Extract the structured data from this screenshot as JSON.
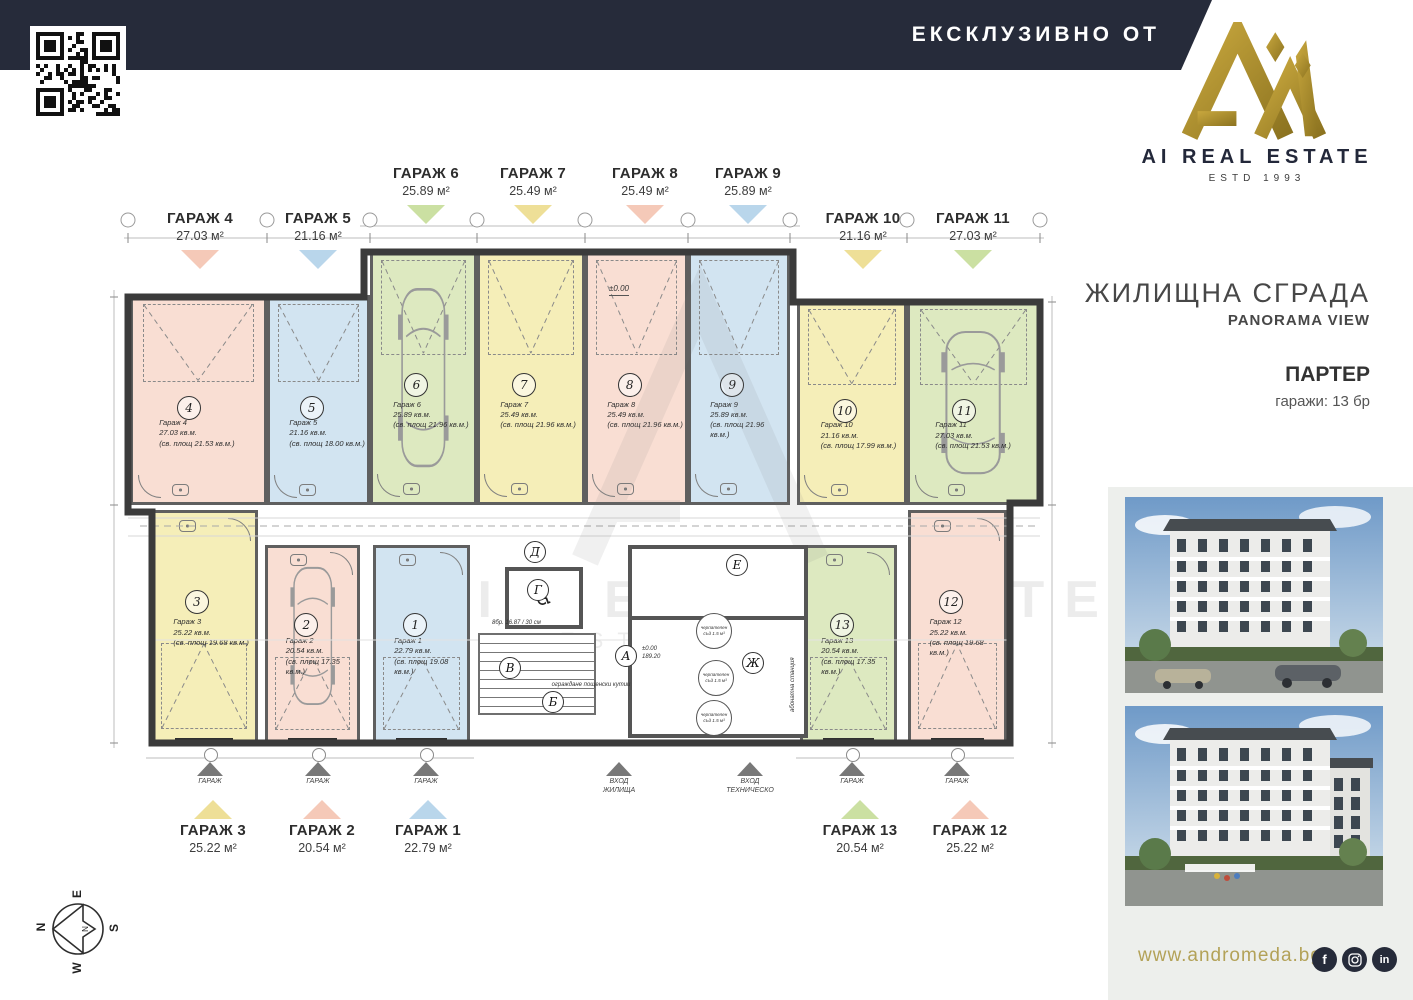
{
  "header": {
    "exclusive": "ЕКСКЛУЗИВНО ОТ"
  },
  "brand": {
    "name": "AI REAL ESTATE",
    "estd": "ESTD 1993"
  },
  "project": {
    "building": "ЖИЛИЩНА СГРАДА",
    "subtitle": "PANORAMA VIEW",
    "floor": "ПАРТЕР",
    "garages_count": "гаражи: 13 бр"
  },
  "footer": {
    "website": "www.andromeda.bg",
    "social": [
      {
        "name": "facebook",
        "glyph": "f"
      },
      {
        "name": "instagram",
        "glyph": ""
      },
      {
        "name": "linkedin",
        "glyph": "in"
      }
    ]
  },
  "compass": {
    "north": "N",
    "east": "E",
    "south": "S",
    "west": "W"
  },
  "colors": {
    "pink": "#f9ded3",
    "blue": "#d2e4f1",
    "green": "#dde9c0",
    "yellow": "#f5eeb8",
    "pink_arrow": "#f5c9b8",
    "blue_arrow": "#b9d6eb",
    "green_arrow": "#cbe0a2",
    "yellow_arrow": "#eedf97",
    "navy": "#262b3a",
    "gold": "#9b8028",
    "gold_text": "#b3a258",
    "panel": "#edefec"
  },
  "plan": {
    "level_mark": "±0.00",
    "area_mark": "189.20",
    "stairs_note": "8бр. 16.87 / 30 см",
    "mailboxes_label": "ограждане пощенски кутии",
    "substation_label": "абонатна станция",
    "tank_label": "черпателен съд 1.5 м³",
    "door_label": "ГАРАЖ",
    "entrances": [
      {
        "line1": "ВХОД",
        "line2": "ЖИЛИЩА"
      },
      {
        "line1": "ВХОД",
        "line2": "ТЕХНИЧЕСКО"
      }
    ],
    "core_rooms": [
      {
        "letter": "А"
      },
      {
        "letter": "Б"
      },
      {
        "letter": "В"
      },
      {
        "letter": "Г"
      },
      {
        "letter": "Д"
      },
      {
        "letter": "Е"
      },
      {
        "letter": "Ж"
      }
    ],
    "garages": [
      {
        "id": 1,
        "label": "ГАРАЖ 1",
        "area": "22.79 м²",
        "inner_name": "Гараж 1",
        "inner_area": "22.79 кв.м.",
        "inner_clear": "(св. площ 19.08 кв.м.)",
        "color": "blue"
      },
      {
        "id": 2,
        "label": "ГАРАЖ 2",
        "area": "20.54 м²",
        "inner_name": "Гараж 2",
        "inner_area": "20.54 кв.м.",
        "inner_clear": "(св. площ 17.35 кв.м.)",
        "color": "pink"
      },
      {
        "id": 3,
        "label": "ГАРАЖ 3",
        "area": "25.22 м²",
        "inner_name": "Гараж 3",
        "inner_area": "25.22 кв.м.",
        "inner_clear": "(св. площ 19.68 кв.м.)",
        "color": "yellow"
      },
      {
        "id": 4,
        "label": "ГАРАЖ 4",
        "area": "27.03 м²",
        "inner_name": "Гараж 4",
        "inner_area": "27.03 кв.м.",
        "inner_clear": "(св. площ 21.53 кв.м.)",
        "color": "pink"
      },
      {
        "id": 5,
        "label": "ГАРАЖ 5",
        "area": "21.16 м²",
        "inner_name": "Гараж 5",
        "inner_area": "21.16 кв.м.",
        "inner_clear": "(св. площ 18.00 кв.м.)",
        "color": "blue"
      },
      {
        "id": 6,
        "label": "ГАРАЖ 6",
        "area": "25.89 м²",
        "inner_name": "Гараж 6",
        "inner_area": "25.89 кв.м.",
        "inner_clear": "(св. площ 21.96 кв.м.)",
        "color": "green"
      },
      {
        "id": 7,
        "label": "ГАРАЖ 7",
        "area": "25.49 м²",
        "inner_name": "Гараж 7",
        "inner_area": "25.49 кв.м.",
        "inner_clear": "(св. площ 21.96 кв.м.)",
        "color": "yellow"
      },
      {
        "id": 8,
        "label": "ГАРАЖ 8",
        "area": "25.49 м²",
        "inner_name": "Гараж 8",
        "inner_area": "25.49 кв.м.",
        "inner_clear": "(св. площ 21.96 кв.м.)",
        "color": "pink"
      },
      {
        "id": 9,
        "label": "ГАРАЖ 9",
        "area": "25.89 м²",
        "inner_name": "Гараж 9",
        "inner_area": "25.89 кв.м.",
        "inner_clear": "(св. площ 21.96 кв.м.)",
        "color": "blue"
      },
      {
        "id": 10,
        "label": "ГАРАЖ 10",
        "area": "21.16 м²",
        "inner_name": "Гараж 10",
        "inner_area": "21.16 кв.м.",
        "inner_clear": "(св. площ 17.99 кв.м.)",
        "color": "yellow"
      },
      {
        "id": 11,
        "label": "ГАРАЖ 11",
        "area": "27.03 м²",
        "inner_name": "Гараж 11",
        "inner_area": "27.03 кв.м.",
        "inner_clear": "(св. площ 21.53 кв.м.)",
        "color": "green"
      },
      {
        "id": 12,
        "label": "ГАРАЖ 12",
        "area": "25.22 м²",
        "inner_name": "Гараж 12",
        "inner_area": "25.22 кв.м.",
        "inner_clear": "(св. площ 19.68 кв.м.)",
        "color": "pink"
      },
      {
        "id": 13,
        "label": "ГАРАЖ 13",
        "area": "20.54 м²",
        "inner_name": "Гараж 13",
        "inner_area": "20.54 кв.м.",
        "inner_clear": "(св. площ 17.35 кв.м.)",
        "color": "green"
      }
    ]
  }
}
